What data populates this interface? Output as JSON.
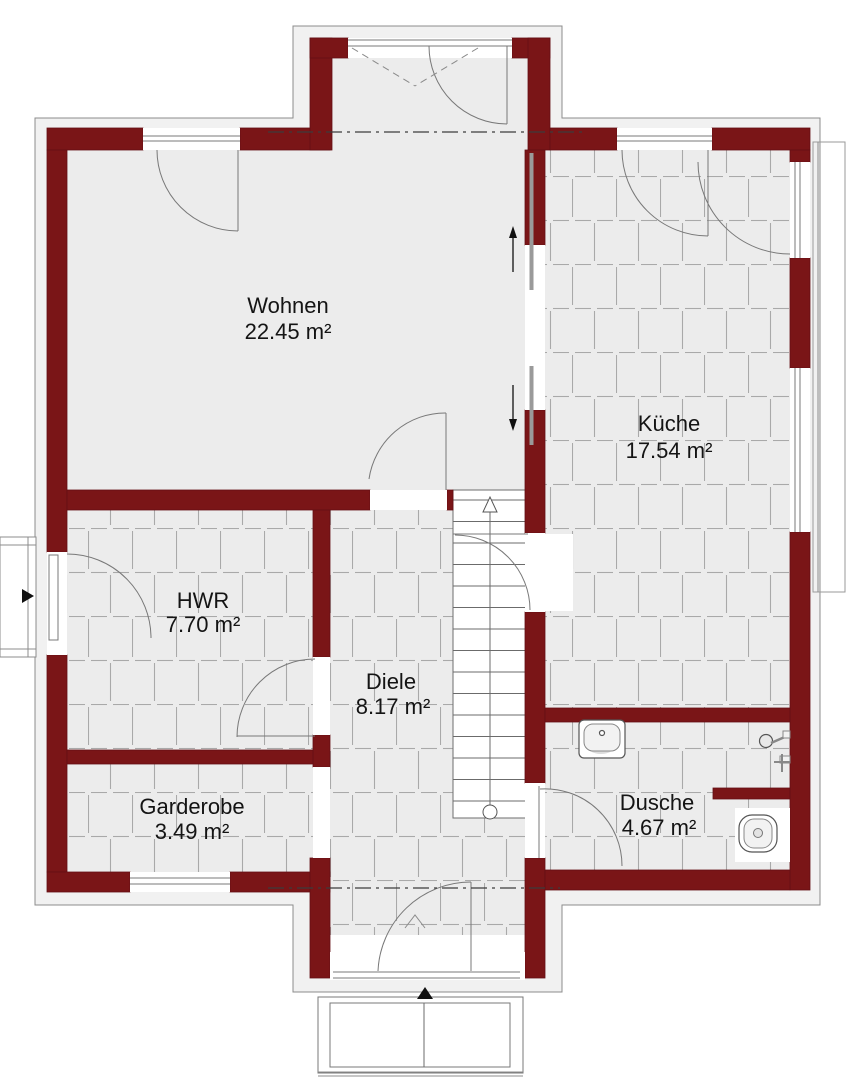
{
  "rooms": [
    {
      "id": "wohnen",
      "name": "Wohnen",
      "area": "22.45 m²"
    },
    {
      "id": "kueche",
      "name": "Küche",
      "area": "17.54 m²"
    },
    {
      "id": "hwr",
      "name": "HWR",
      "area": "7.70 m²"
    },
    {
      "id": "diele",
      "name": "Diele",
      "area": "8.17 m²"
    },
    {
      "id": "garderobe",
      "name": "Garderobe",
      "area": "3.49 m²"
    },
    {
      "id": "dusche",
      "name": "Dusche",
      "area": "4.67 m²"
    }
  ],
  "colors": {
    "wall": "#7a1517",
    "floor": "#ececec",
    "tile_line": "#a9a9a9",
    "outline_band": "#f1f1f1"
  }
}
